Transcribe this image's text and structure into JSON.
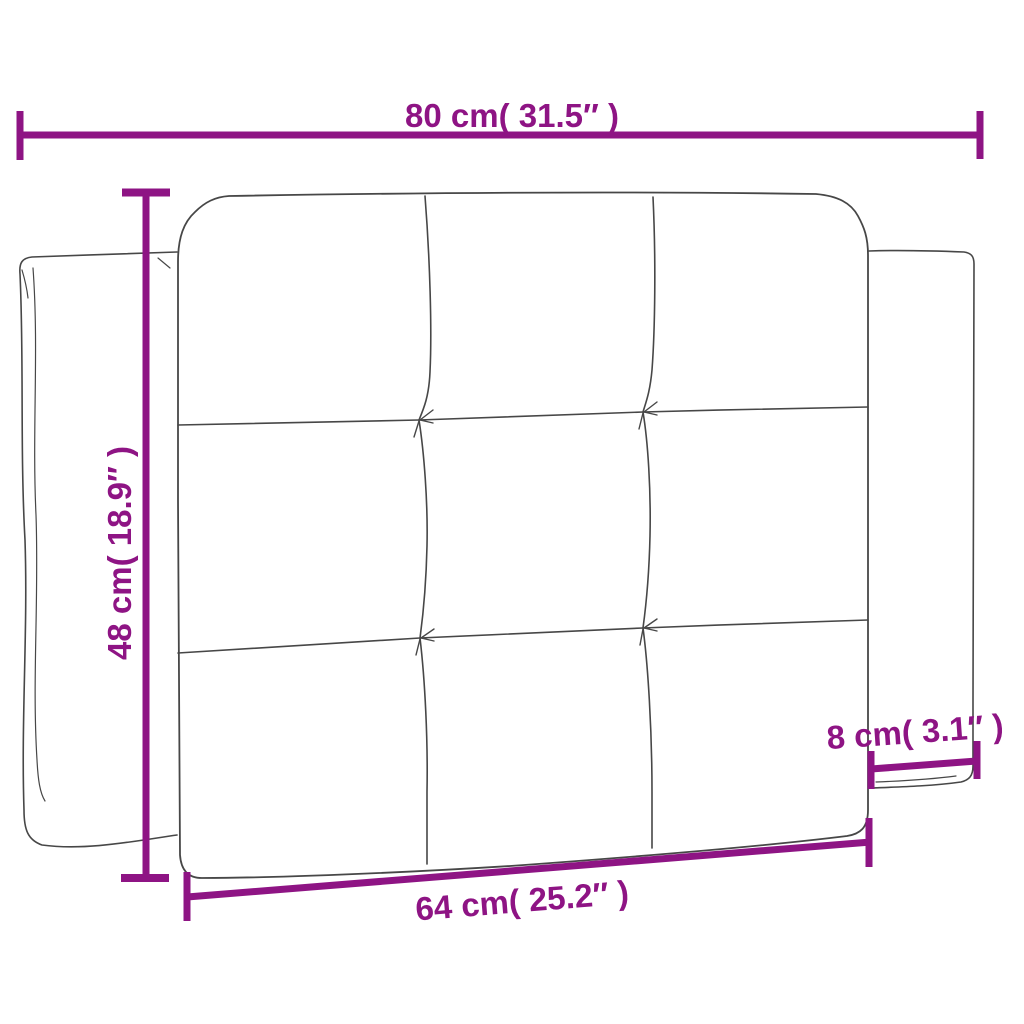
{
  "colors": {
    "dimension_accent": "#8E1484",
    "line_art": "#474747",
    "background": "#FFFFFF"
  },
  "diagram": {
    "type": "product-dimension-diagram",
    "subject": "tufted headboard cushion with 3x3 panels and side back panels",
    "labels": {
      "top_width": "80 cm( 31.5″ )",
      "left_height": "48 cm( 18.9″ )",
      "right_depth": "8 cm( 3.1″ )",
      "bottom_inner_width": "64 cm( 25.2″ )"
    },
    "measurements": {
      "overall_width": {
        "cm": 80,
        "in": 31.5
      },
      "height": {
        "cm": 48,
        "in": 18.9
      },
      "side_panel_depth": {
        "cm": 8,
        "in": 3.1
      },
      "inner_width": {
        "cm": 64,
        "in": 25.2
      }
    }
  }
}
